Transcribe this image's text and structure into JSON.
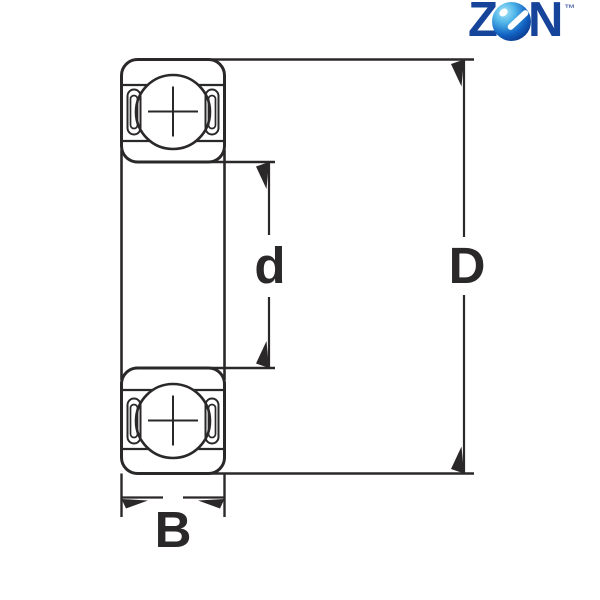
{
  "logo": {
    "letter_z": "Z",
    "letter_n": "N",
    "trademark": "™",
    "letter_color": "#17449b",
    "ball_colors": {
      "highlight": "#a9e6f9",
      "mid": "#1263c3",
      "dark": "#062158",
      "accents": "#ffffff"
    }
  },
  "dimensions": {
    "bore": "d",
    "outer": "D",
    "width": "B"
  },
  "drawing": {
    "ink_color": "#2b282a",
    "background_color": "#ffffff"
  }
}
